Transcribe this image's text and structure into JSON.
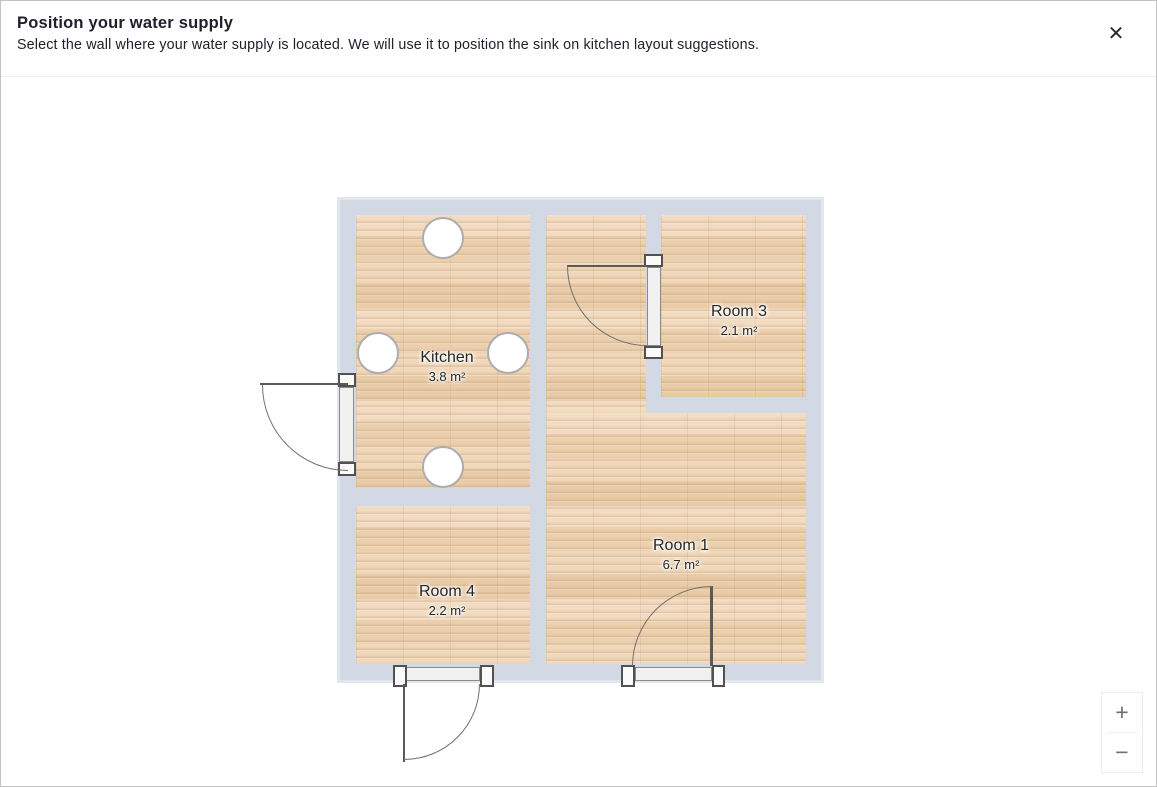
{
  "header": {
    "title": "Position your water supply",
    "subtitle": "Select the wall where your water supply is located. We will use it to position the sink on kitchen layout suggestions.",
    "close_icon": "✕"
  },
  "floorplan": {
    "rooms": [
      {
        "name": "Kitchen",
        "area": "3.8 m²"
      },
      {
        "name": "Room 1",
        "area": "6.7 m²"
      },
      {
        "name": "Room 3",
        "area": "2.1 m²"
      },
      {
        "name": "Room 4",
        "area": "2.2 m²"
      }
    ],
    "wall_marker_count": 4,
    "door_count": 4
  },
  "zoom_controls": {
    "zoom_in": "+",
    "zoom_out": "−"
  },
  "colors": {
    "wall": "#d3d9e4",
    "floor": "#eed2b4",
    "door_line": "#5a5a5a",
    "arc_line": "#707070",
    "marker_border": "#adadad",
    "text": "#20202b"
  }
}
